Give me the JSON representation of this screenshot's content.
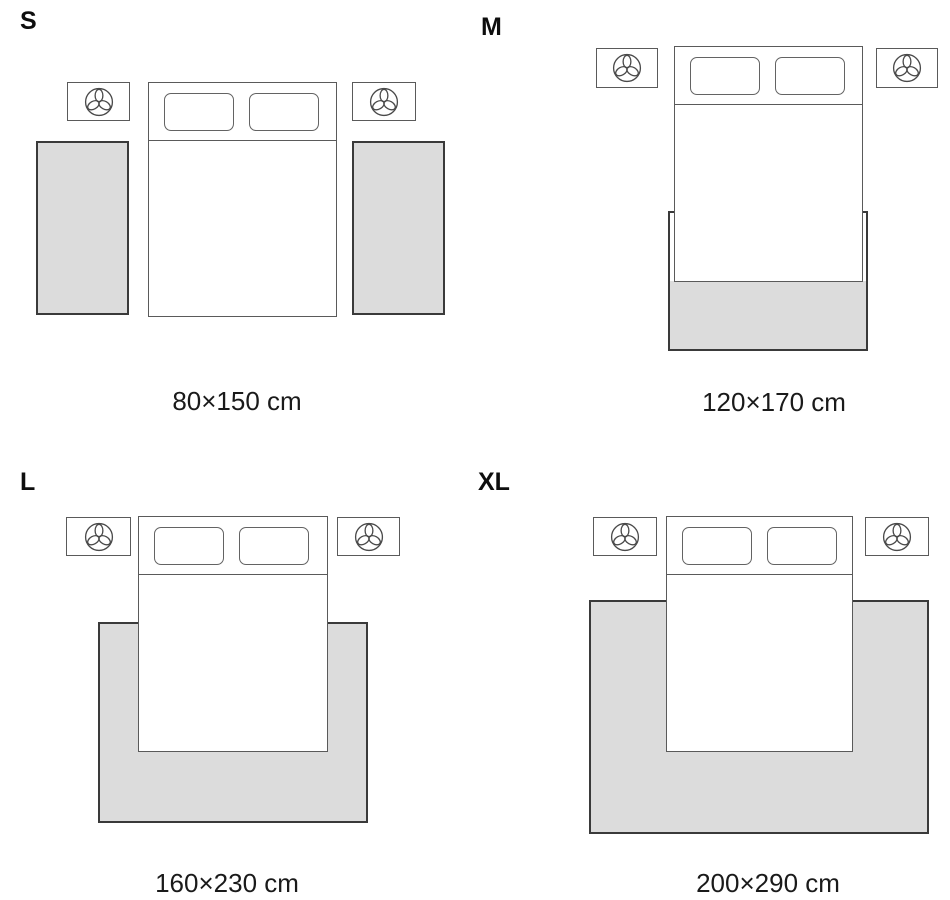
{
  "diagram": {
    "background_color": "#ffffff",
    "furniture_stroke_color": "#5a5a5a",
    "rug_fill_color": "#dcdcdc",
    "rug_stroke_color": "#3a3a3a",
    "text_color": "#1a1a1a",
    "nightstand_icon": "plant-icon"
  },
  "layouts": [
    {
      "size_label": "S",
      "dimensions": "80×150 cm"
    },
    {
      "size_label": "M",
      "dimensions": "120×170 cm"
    },
    {
      "size_label": "L",
      "dimensions": "160×230 cm"
    },
    {
      "size_label": "XL",
      "dimensions": "200×290 cm"
    }
  ]
}
